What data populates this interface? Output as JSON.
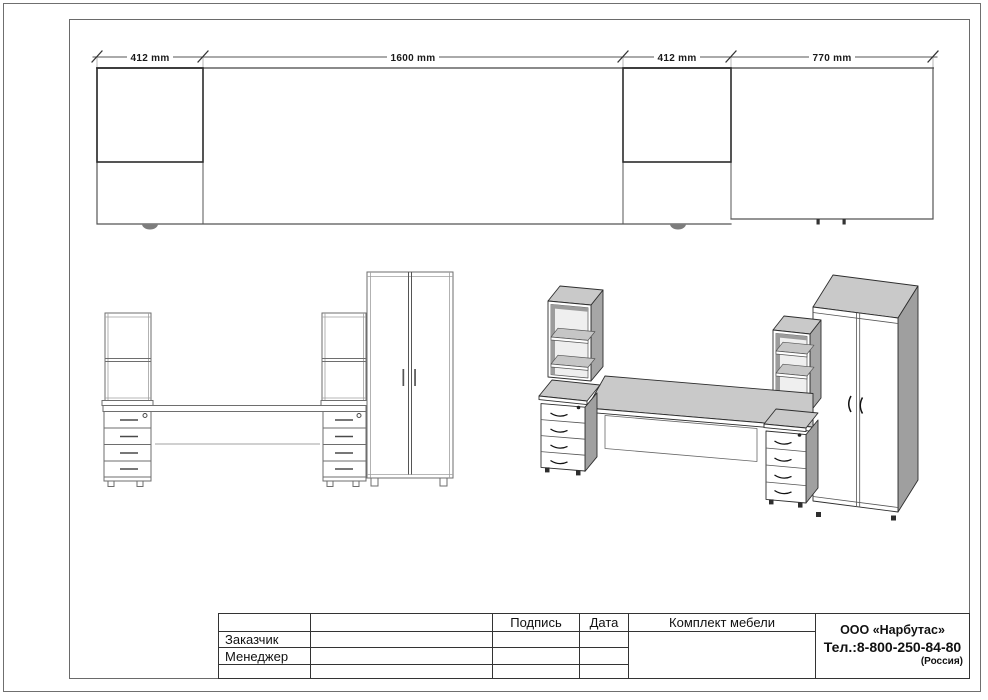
{
  "plan_dimensions": {
    "d1": "412 mm",
    "d2": "1600 mm",
    "d3": "412 mm",
    "d4": "770 mm"
  },
  "title_block": {
    "signature_label": "Подпись",
    "date_label": "Дата",
    "customer_label": "Заказчик",
    "manager_label": "Менеджер",
    "product_title": "Комплект мебели",
    "company_name": "ООО «Нарбутас»",
    "company_phone": "Тел.:8-800-250-84-80",
    "company_country": "(Россия)"
  },
  "colors": {
    "paper": "#ffffff",
    "frame_line": "#6a6a6a",
    "drawing_line": "#666666",
    "dark_line": "#2b2b2b",
    "iso_top_fill": "#c9c9c9",
    "iso_side_fill": "#a3a3a3",
    "iso_front_fill": "#ffffff",
    "iso_shadow_fill": "#9c9c9c"
  }
}
